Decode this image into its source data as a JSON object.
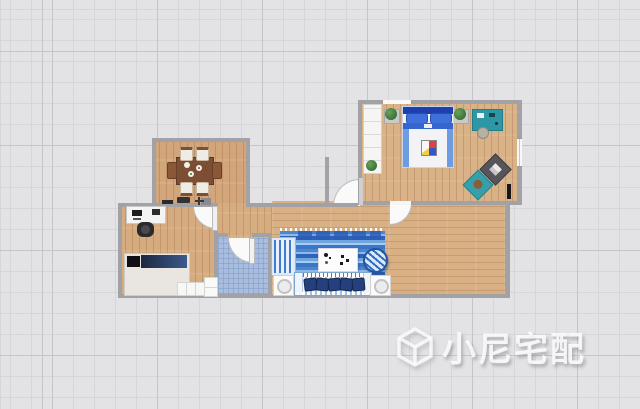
{
  "watermark": {
    "text": "小尼宅配",
    "logo": "isometric-cube"
  },
  "palette": {
    "background": "#e3e3e5",
    "grid_minor": "#d6d6d9",
    "grid_major": "#c5c5c9",
    "wall": "#a2a2a6",
    "wood_dining": "#d2a67a",
    "wood_study": "#d5ab7f",
    "wood_living": "#d8b084",
    "wood_bedroom": "#d9b288",
    "bath_tile": "#a9bedf",
    "rug_blue": "#3a76c8",
    "teal_furniture": "#2d97a6",
    "bed_blue": "#1e3fae"
  },
  "rooms": [
    {
      "name": "dining-room",
      "floor": "wood",
      "items": [
        "dining-table",
        "six-chairs",
        "tableware",
        "wall-fixtures"
      ]
    },
    {
      "name": "study-bedroom",
      "floor": "wood",
      "items": [
        "computer-desk",
        "desk-chair",
        "single-bed",
        "storage-cabinet"
      ]
    },
    {
      "name": "bathroom",
      "floor": "blue-tile",
      "items": [
        "swing-door"
      ]
    },
    {
      "name": "living-room",
      "floor": "wood",
      "items": [
        "striped-rug",
        "coffee-table",
        "striped-sofa",
        "striped-armchair",
        "round-lounge-chair",
        "side-table-lamp-left",
        "side-table-lamp-right"
      ]
    },
    {
      "name": "master-bedroom",
      "floor": "wood",
      "items": [
        "double-bed",
        "wardrobe",
        "plant-left",
        "plant-right",
        "teal-dresser",
        "stool",
        "writing-desk",
        "desk-chair-teal",
        "wall-tv",
        "window"
      ]
    },
    {
      "name": "entry-porch",
      "items": [
        "entry-door"
      ]
    }
  ]
}
